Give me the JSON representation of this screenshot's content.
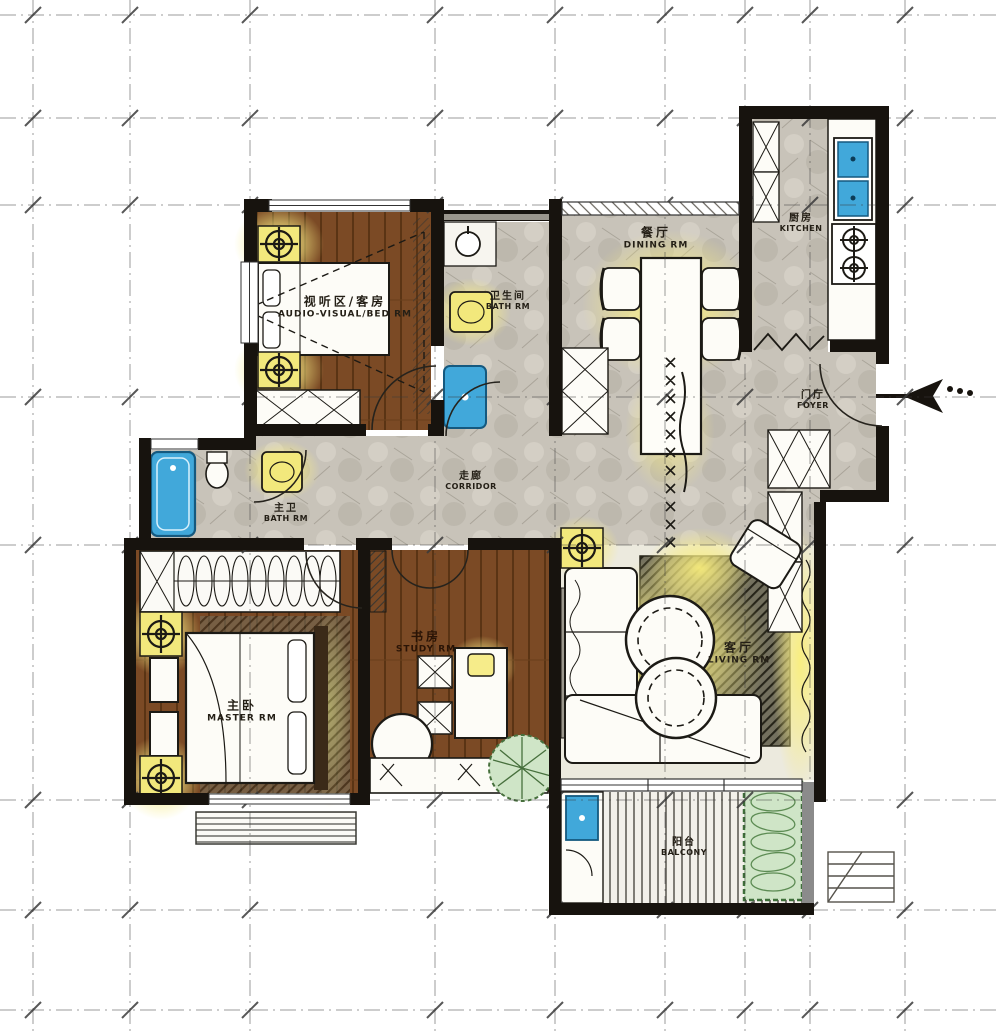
{
  "plan": {
    "title": "Hand-rendered apartment floor plan",
    "rooms": [
      {
        "id": "av-bed-room",
        "zh": "视听区/客房",
        "en": "AUDIO-VISUAL/BED RM"
      },
      {
        "id": "bath-room",
        "zh": "卫生间",
        "en": "BATH RM"
      },
      {
        "id": "dining-room",
        "zh": "餐厅",
        "en": "DINING RM"
      },
      {
        "id": "kitchen",
        "zh": "厨房",
        "en": "KITCHEN"
      },
      {
        "id": "foyer",
        "zh": "门厅",
        "en": "FOYER"
      },
      {
        "id": "corridor",
        "zh": "走廊",
        "en": "CORRIDOR"
      },
      {
        "id": "master-bath",
        "zh": "主卫",
        "en": "BATH RM"
      },
      {
        "id": "master-room",
        "zh": "主卧",
        "en": "MASTER RM"
      },
      {
        "id": "study-room",
        "zh": "书房",
        "en": "STUDY RM"
      },
      {
        "id": "living-room",
        "zh": "客厅",
        "en": "LIVING RM"
      },
      {
        "id": "balcony",
        "zh": "阳台",
        "en": "BALCONY"
      }
    ],
    "colors": {
      "wall": "#17130e",
      "stone_floor": "#c8c3b9",
      "wood_floor": "#7b4a25",
      "accent_yellow": "#f2e87c",
      "glow_yellow": "#f9ee8e",
      "water_blue": "#41a8da",
      "plant_green": "#cfe5c7",
      "rug_dark": "#73705e"
    },
    "fixtures": [
      "bed",
      "projector-cone",
      "speaker-stand",
      "wardrobe",
      "washbasin",
      "shower",
      "bathtub",
      "toilet",
      "dining-table",
      "dining-chair",
      "table-runner",
      "kitchen-sink",
      "cooktop",
      "fridge-cabinet",
      "bifold-door",
      "shoe-cabinet",
      "entrance-arrow",
      "sofa",
      "armchair",
      "round-coffee-table",
      "rug",
      "tv-console",
      "desk",
      "desk-chair",
      "reading-table",
      "window-bench",
      "potted-plant",
      "double-bed",
      "nightstand",
      "clothes-rail",
      "planter-box",
      "laundry-sink",
      "drying-rack"
    ]
  }
}
